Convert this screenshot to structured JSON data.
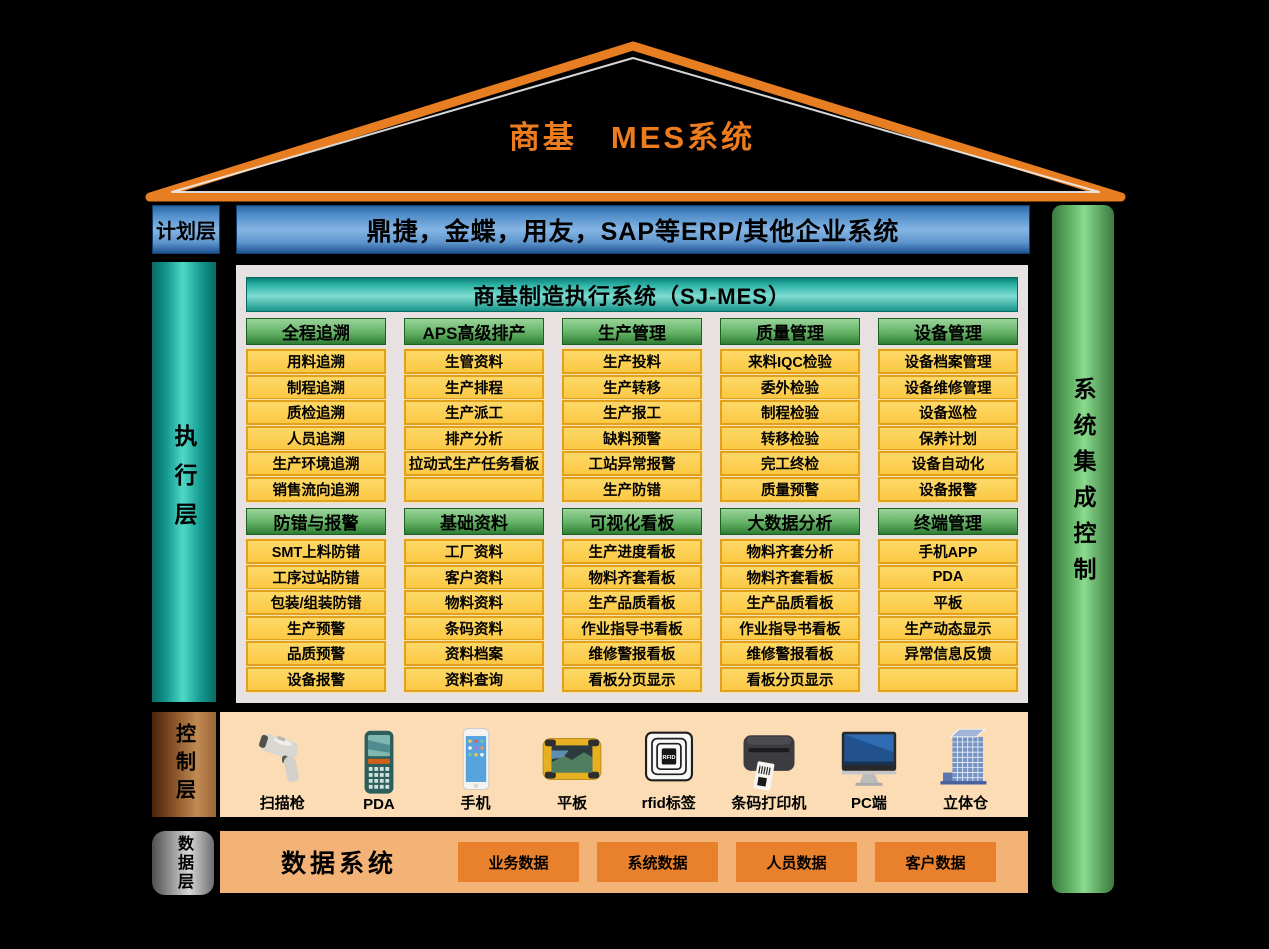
{
  "title": "商基　MES系统",
  "colors": {
    "roof_orange": "#E87E22",
    "title_orange": "#ED7C1E",
    "plan_blue": "#85B5E4",
    "exec_teal": "#4FD8C8",
    "header_green": "#63B265",
    "item_yellow": "#FBC843",
    "control_copper": "#C08A55",
    "control_bg": "#FBDCB4",
    "data_bg": "#F3B377",
    "data_chip_orange": "#E8802C",
    "sys_bar_green": "#8ADB8D",
    "panel_gray": "#E7E1E1"
  },
  "layers": {
    "plan": {
      "label": "计划层",
      "erp_bar": "鼎捷，金蝶，用友，SAP等ERP/其他企业系统"
    },
    "execute": {
      "label": "执行层"
    },
    "control": {
      "label": "控制层"
    },
    "data": {
      "label": "数据层"
    }
  },
  "right_bar": {
    "label": "系统集成控制"
  },
  "mes": {
    "header": "商基制造执行系统（SJ-MES）",
    "row1": [
      {
        "header": "全程追溯",
        "items": [
          "用料追溯",
          "制程追溯",
          "质检追溯",
          "人员追溯",
          "生产环境追溯",
          "销售流向追溯"
        ]
      },
      {
        "header": "APS高级排产",
        "items": [
          "生管资料",
          "生产排程",
          "生产派工",
          "排产分析",
          "拉动式生产任务看板",
          ""
        ]
      },
      {
        "header": "生产管理",
        "items": [
          "生产投料",
          "生产转移",
          "生产报工",
          "缺料预警",
          "工站异常报警",
          "生产防错"
        ]
      },
      {
        "header": "质量管理",
        "items": [
          "来料IQC检验",
          "委外检验",
          "制程检验",
          "转移检验",
          "完工终检",
          "质量预警"
        ]
      },
      {
        "header": "设备管理",
        "items": [
          "设备档案管理",
          "设备维修管理",
          "设备巡检",
          "保养计划",
          "设备自动化",
          "设备报警"
        ]
      }
    ],
    "row2": [
      {
        "header": "防错与报警",
        "items": [
          "SMT上料防错",
          "工序过站防错",
          "包装/组装防错",
          "生产预警",
          "品质预警",
          "设备报警"
        ]
      },
      {
        "header": "基础资料",
        "items": [
          "工厂资料",
          "客户资料",
          "物料资料",
          "条码资料",
          "资料档案",
          "资料查询"
        ]
      },
      {
        "header": "可视化看板",
        "items": [
          "生产进度看板",
          "物料齐套看板",
          "生产品质看板",
          "作业指导书看板",
          "维修警报看板",
          "看板分页显示"
        ]
      },
      {
        "header": "大数据分析",
        "items": [
          "物料齐套分析",
          "物料齐套看板",
          "生产品质看板",
          "作业指导书看板",
          "维修警报看板",
          "看板分页显示"
        ]
      },
      {
        "header": "终端管理",
        "items": [
          "手机APP",
          "PDA",
          "平板",
          "生产动态显示",
          "异常信息反馈",
          ""
        ]
      }
    ]
  },
  "devices": [
    {
      "name": "扫描枪",
      "icon": "barcode-scanner-icon"
    },
    {
      "name": "PDA",
      "icon": "pda-icon"
    },
    {
      "name": "手机",
      "icon": "phone-icon"
    },
    {
      "name": "平板",
      "icon": "tablet-icon"
    },
    {
      "name": "rfid标签",
      "icon": "rfid-tag-icon"
    },
    {
      "name": "条码打印机",
      "icon": "barcode-printer-icon"
    },
    {
      "name": "PC端",
      "icon": "pc-icon"
    },
    {
      "name": "立体仓",
      "icon": "warehouse-icon"
    }
  ],
  "data_layer": {
    "system_label": "数据系统",
    "buttons": [
      "业务数据",
      "系统数据",
      "人员数据",
      "客户数据"
    ]
  }
}
